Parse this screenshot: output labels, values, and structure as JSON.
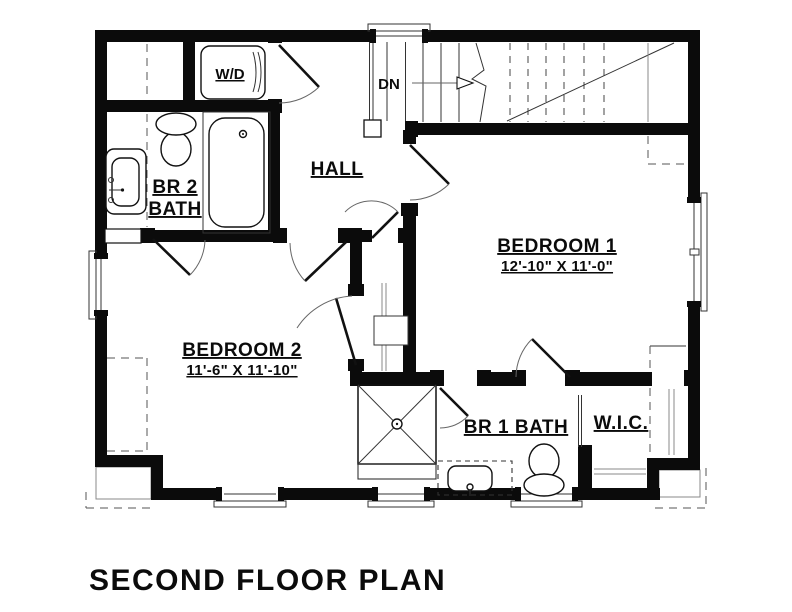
{
  "title": "SECOND FLOOR PLAN",
  "colors": {
    "ink": "#0b0b0b",
    "background": "#ffffff",
    "thin_line": "#555555"
  },
  "plan": {
    "stairs": {
      "label": "DN"
    },
    "laundry": {
      "label": "W/D"
    },
    "hall": {
      "label": "HALL"
    },
    "bedroom1": {
      "label": "BEDROOM 1",
      "dims": "12'-10\" X 11'-0\""
    },
    "bedroom2": {
      "label": "BEDROOM 2",
      "dims": "11'-6\" X 11'-10\""
    },
    "br2_bath": {
      "label1": "BR 2",
      "label2": "BATH"
    },
    "br1_bath": {
      "label": "BR 1 BATH"
    },
    "wic": {
      "label": "W.I.C."
    }
  }
}
